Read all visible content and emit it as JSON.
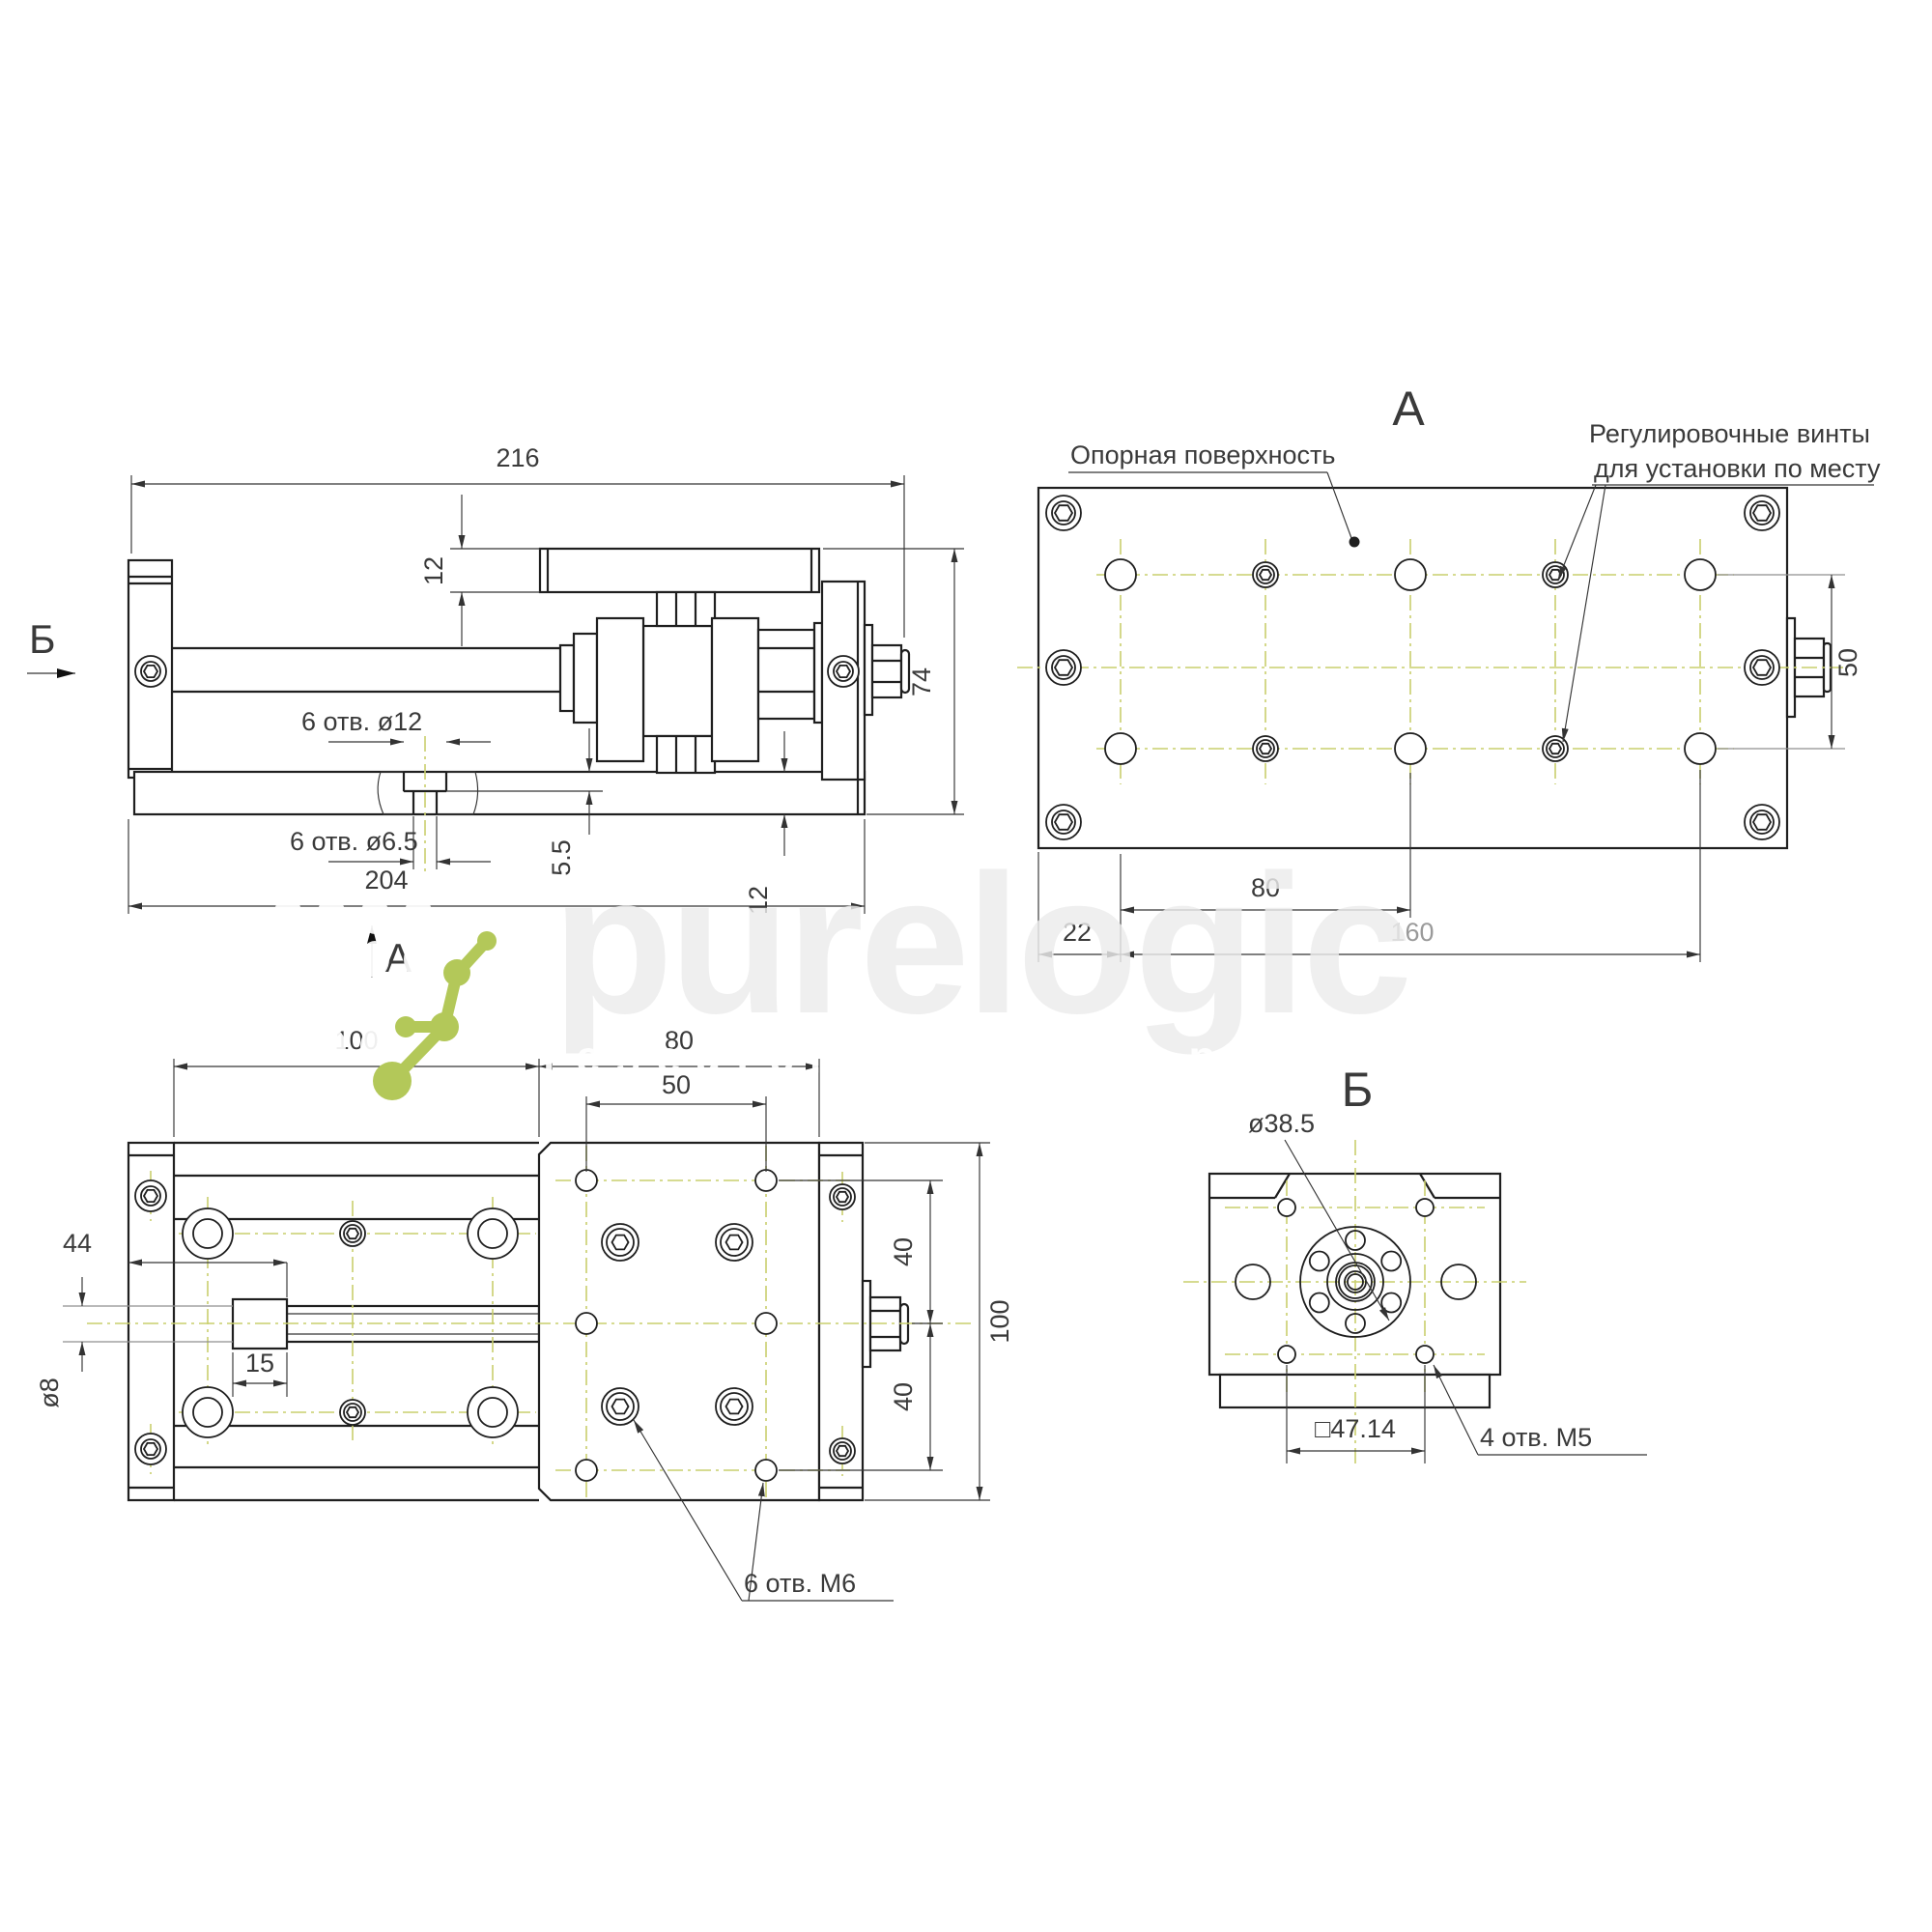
{
  "page": {
    "background": "#ffffff",
    "type": "engineering-drawing"
  },
  "colors": {
    "line": "#1f1f1f",
    "centerline_green": "#c9cf6d",
    "logo_green": "#b3c859",
    "watermark_gray": "#ececec"
  },
  "watermark": {
    "brand": "purelogic",
    "tagline": "research & development"
  },
  "views": {
    "side": {
      "labels": {
        "section_b": "Б",
        "section_a": "А"
      },
      "dims": {
        "length": "216",
        "plate_thickness": "12",
        "height": "74",
        "counterbore_label": "6 отв. ø12",
        "through_label": "6 отв. ø6.5",
        "cb_depth": "5.5",
        "base_length": "204",
        "base_thickness": "12"
      }
    },
    "a": {
      "title": "А",
      "labels": {
        "surface": "Опорная поверхность",
        "adjust1": "Регулировочные винты",
        "adjust2": "для установки по месту"
      },
      "dims": {
        "pitch": "80",
        "edge": "22",
        "span": "160",
        "rows": "50"
      }
    },
    "top": {
      "labels": {
        "holes": "6 отв. М6"
      },
      "dims": {
        "exposed": "100",
        "table": "80",
        "cols": "50",
        "offset": "44",
        "flat": "15",
        "shaft": "ø8",
        "row_a": "40",
        "row_b": "40",
        "width": "100"
      }
    },
    "b": {
      "title": "Б",
      "labels": {
        "holes": "4 отв. М5"
      },
      "dims": {
        "flange": "ø38.5",
        "square": "□47.14"
      }
    }
  }
}
